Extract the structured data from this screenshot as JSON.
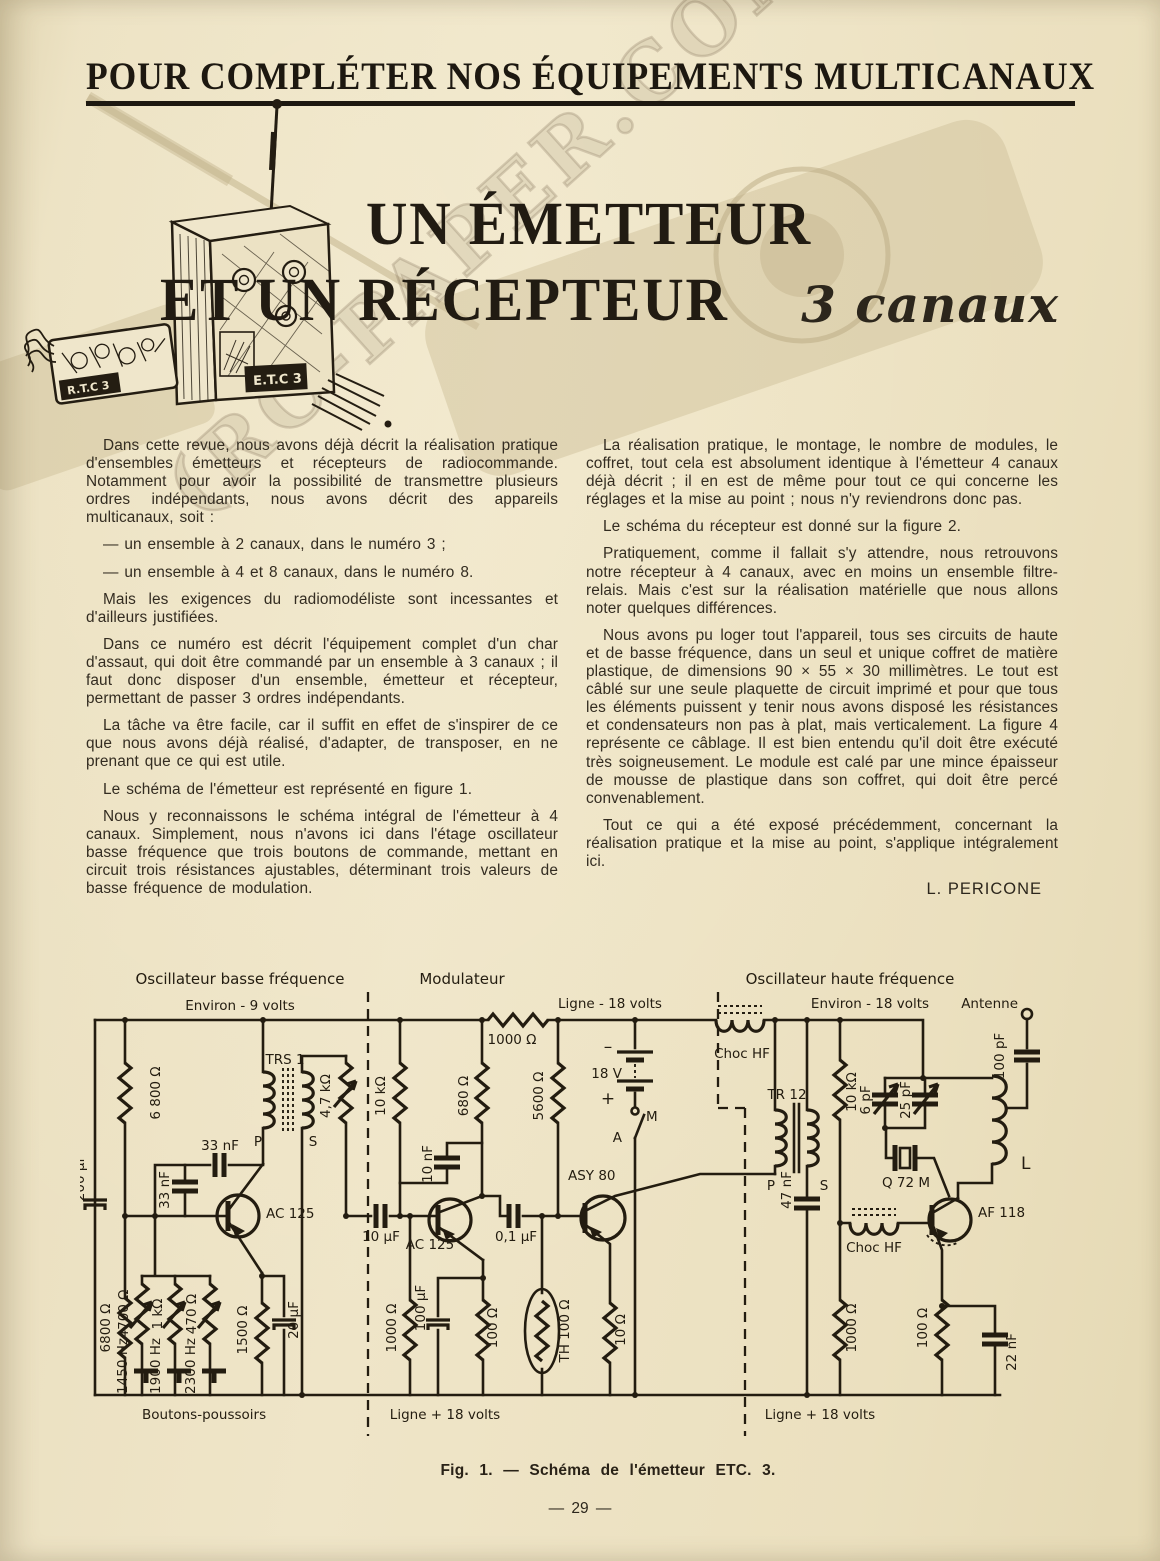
{
  "page": {
    "header": "POUR COMPLÉTER NOS ÉQUIPEMENTS MULTICANAUX",
    "page_number": "— 29 —",
    "watermark": "(RC-PAPER.COM"
  },
  "title": {
    "line1": "UN ÉMETTEUR",
    "line2": "ET UN RÉCEPTEUR",
    "suffix": "3 canaux"
  },
  "illustration": {
    "transmitter_label": "E.T.C 3",
    "receiver_label": "R.T.C 3"
  },
  "article": {
    "left_column": [
      "Dans cette revue, nous avons déjà décrit la réalisation pratique d'ensembles émetteurs et récepteurs de radiocommande. Notamment pour avoir la possibilité de transmettre plusieurs ordres indépendants, nous avons décrit des appareils multicanaux, soit :",
      "— un ensemble à 2 canaux, dans le numéro 3 ;",
      "— un ensemble à 4 et 8 canaux, dans le numéro 8.",
      "Mais les exigences du radiomodéliste sont incessantes et d'ailleurs justifiées.",
      "Dans ce numéro est décrit l'équipement complet d'un char d'assaut, qui doit être commandé par un ensemble à 3 canaux ; il faut donc disposer d'un ensemble, émetteur et récepteur, permettant de passer 3 ordres indépendants.",
      "La tâche va être facile, car il suffit en effet de s'inspirer de ce que nous avons déjà réalisé, d'adapter, de transposer, en ne prenant que ce qui est utile.",
      "Le schéma de l'émetteur est représenté en figure 1.",
      "Nous y reconnaissons le schéma intégral de l'émetteur à 4 canaux. Simplement, nous n'avons ici dans l'étage oscillateur basse fréquence que trois boutons de commande, mettant en circuit trois résistances ajustables, déterminant trois valeurs de basse fréquence de modulation."
    ],
    "right_column": [
      "La réalisation pratique, le montage, le nombre de modules, le coffret, tout cela est absolument identique à l'émetteur 4 canaux déjà décrit ; il en est de même pour tout ce qui concerne les réglages et la mise au point ; nous n'y reviendrons donc pas.",
      "Le schéma du récepteur est donné sur la figure 2.",
      "Pratiquement, comme il fallait s'y attendre, nous retrouvons notre récepteur à 4 canaux, avec en moins un ensemble filtre-relais. Mais c'est sur la réalisation matérielle que nous allons noter quelques différences.",
      "Nous avons pu loger tout l'appareil, tous ses circuits de haute et de basse fréquence, dans un seul et unique coffret de matière plastique, de dimensions 90 × 55 × 30 millimètres. Le tout est câblé sur une seule plaquette de circuit imprimé et pour que tous les éléments puissent y tenir nous avons disposé les résistances et condensateurs non pas à plat, mais verticalement. La figure 4 représente ce câblage. Il est bien entendu qu'il doit être exécuté très soigneusement. Le module est calé par une mince épaisseur de mousse de plastique dans son coffret, qui doit être percé convenablement.",
      "Tout ce qui a été exposé précédemment, concernant la réalisation pratique et la mise au point, s'applique intégralement ici."
    ],
    "author": "L. PERICONE"
  },
  "figure": {
    "caption": "Fig. 1. — Schéma de l'émetteur ETC. 3."
  },
  "schematic": {
    "sections": {
      "bf": "Oscillateur basse fréquence",
      "mod": "Modulateur",
      "hf": "Oscillateur haute fréquence"
    },
    "labels": {
      "env9": "Environ - 9 volts",
      "ligne_m18": "Ligne - 18 volts",
      "env18": "Environ - 18 volts",
      "antenne": "Antenne",
      "boutons": "Boutons-poussoirs",
      "ligne_p18_a": "Ligne + 18 volts",
      "ligne_p18_b": "Ligne + 18 volts",
      "c200": "200 µF",
      "r6800_top": "6 800 Ω",
      "c33_h": "33 nF",
      "c33_v": "33 nF",
      "trs1": "TRS 1",
      "p1": "P",
      "s1": "S",
      "r47k": "4,7 kΩ",
      "ac125_a": "AC 125",
      "r6800_bot": "6800 Ω",
      "r4700": "4700 Ω",
      "hz1450": "1450 Hz",
      "r1k": "1 kΩ",
      "hz1900": "1900 Hz",
      "r470": "470 Ω",
      "hz2300": "2300 Hz",
      "r1500": "1500 Ω",
      "c20": "20 µF",
      "r1000_top": "1000 Ω",
      "r10k_mod": "10 kΩ",
      "c10n": "10 nF",
      "r680": "680 Ω",
      "r5600": "5600 Ω",
      "minus": "–",
      "v18": "18 V",
      "plus": "+",
      "m": "M",
      "a": "A",
      "asy80": "ASY 80",
      "c10u": "10 µF",
      "ac125_b": "AC 125",
      "c01u": "0,1 µF",
      "r1000_mod": "1000 Ω",
      "c100u": "100 µF",
      "r100_mod": "100 Ω",
      "th100": "TH 100 Ω",
      "r10": "10 Ω",
      "tr12": "TR 12",
      "p2": "P",
      "s2": "S",
      "choc1": "Choc HF",
      "choc2": "Choc HF",
      "c47n": "47 nF",
      "r10k_hf": "10 kΩ",
      "c6p": "6 pF",
      "c25p": "25 pF",
      "q72": "Q 72 M",
      "l": "L",
      "c100p": "100 pF",
      "af118": "AF 118",
      "r1000_hf": "1000 Ω",
      "r100_hf": "100 Ω",
      "c22n": "22 nF"
    }
  }
}
